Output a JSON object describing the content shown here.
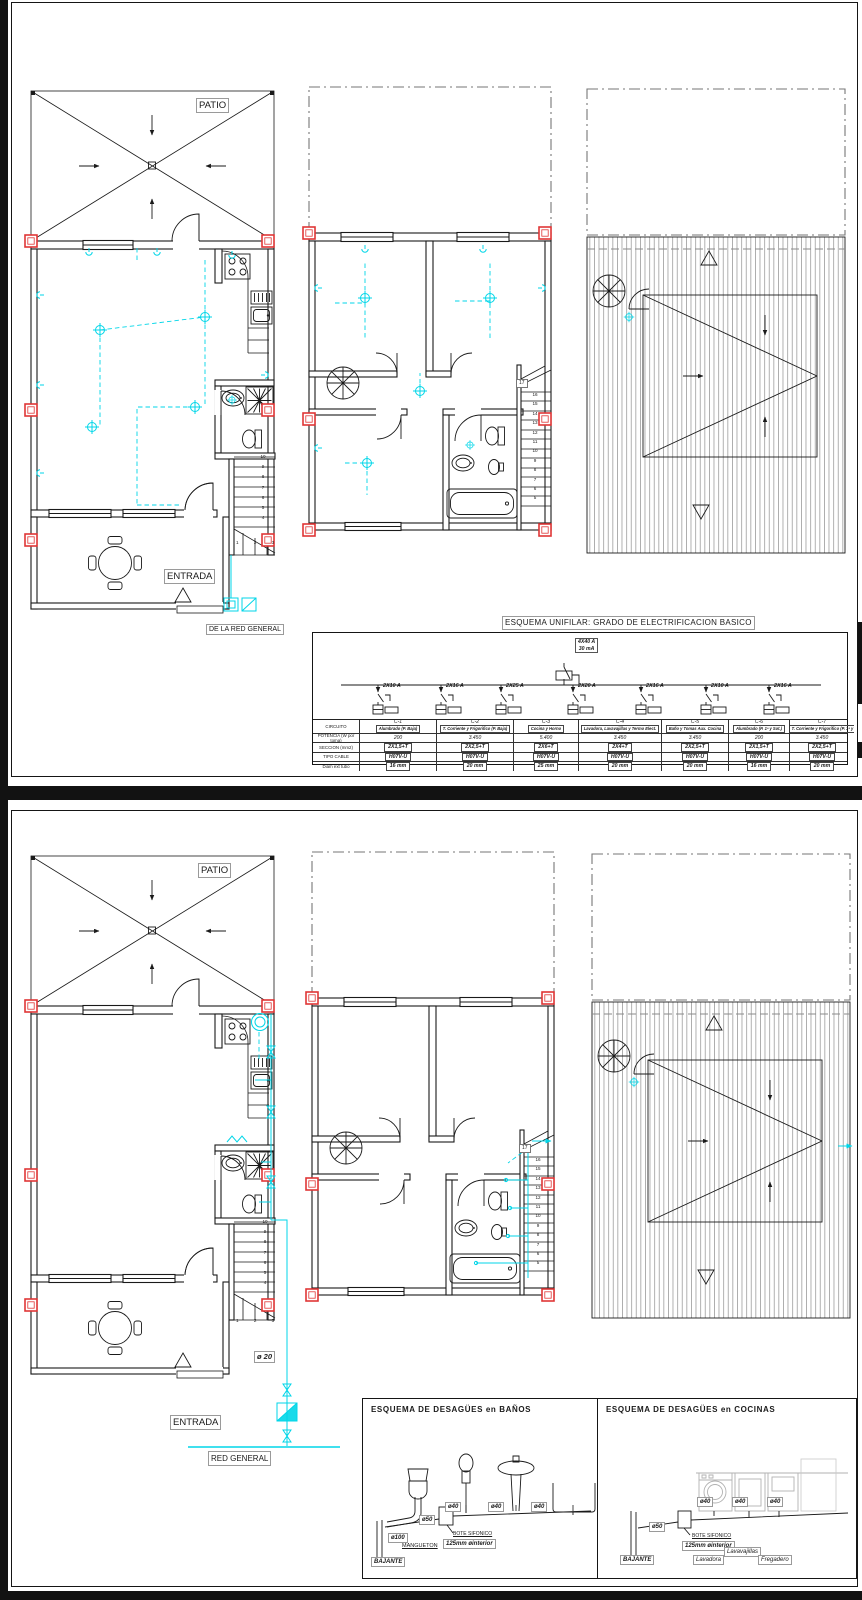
{
  "sheet1": {
    "ground": {
      "patio_label": "PATIO",
      "entrada_label": "ENTRADA",
      "service_label": "DE LA RED GENERAL",
      "stairs_col": "10\n9\n8\n7\n6\n5\n4",
      "stairs_bottom": "1 2 3"
    },
    "first": {
      "stairs_top": "17",
      "stairs_col": "16\n15\n14\n13\n12\n11\n10\n9\n8\n7\n6\n5"
    },
    "unifilar": {
      "title": "ESQUEMA UNIFILAR: GRADO DE ELECTRIFICACION BASICO",
      "main_breaker_a": "4X40 A",
      "main_breaker_ma": "30 mA",
      "breakers": [
        {
          "label": "2X10 A"
        },
        {
          "label": "2X16 A"
        },
        {
          "label": "2X25 A"
        },
        {
          "label": "2X20 A"
        },
        {
          "label": "2X16 A"
        },
        {
          "label": "2X10 A"
        },
        {
          "label": "2X16 A"
        }
      ],
      "row_labels": {
        "circuito": "CIRCUITO",
        "potencia": "POTENCIA (W por toma)",
        "seccion": "SECCION (mm2)",
        "cable": "TIPO CABLE",
        "diam": "Diam ext tubo"
      },
      "circuits": [
        {
          "id": "C-1",
          "name": "Alumbrado (P. Baja)",
          "pot": "200",
          "sec": "2X1,5+T",
          "cable": "H07V-U",
          "diam": "16 mm"
        },
        {
          "id": "C-2",
          "name": "T. Corriente y Frigorifico (P. Baja)",
          "pot": "3.450",
          "sec": "2X2,5+T",
          "cable": "H07V-U",
          "diam": "20 mm"
        },
        {
          "id": "C-3",
          "name": "Cocina y Horno",
          "pot": "5.400",
          "sec": "2X6+T",
          "cable": "H07V-U",
          "diam": "25 mm"
        },
        {
          "id": "C-4",
          "name": "Lavadora, Lavavajillas y Termo Elect.",
          "pot": "3.450",
          "sec": "2X4+T",
          "cable": "H07V-U",
          "diam": "20 mm"
        },
        {
          "id": "C-5",
          "name": "Baño y Tomas Aux. Cocina",
          "pot": "3.450",
          "sec": "2X2,5+T",
          "cable": "H07V-U",
          "diam": "20 mm"
        },
        {
          "id": "C-6",
          "name": "Alumbrado (P. 1ª y Sot.)",
          "pot": "200",
          "sec": "2X1,5+T",
          "cable": "H07V-U",
          "diam": "16 mm"
        },
        {
          "id": "C-7",
          "name": "T. Corriente y Frigorifico (P. 1ª y Sot.)",
          "pot": "3.450",
          "sec": "2X2,5+T",
          "cable": "H07V-U",
          "diam": "20 mm"
        }
      ]
    }
  },
  "sheet2": {
    "ground": {
      "patio_label": "PATIO",
      "entrada_label": "ENTRADA",
      "red_general_label": "RED GENERAL",
      "pipe_label": "ø 20",
      "stairs_col": "10\n9\n8\n7\n6\n5\n4",
      "stairs_bottom": "1 2 3"
    },
    "first": {
      "stairs_top": "17",
      "stairs_col": "16\n15\n14\n13\n12\n11\n10\n9\n8\n7\n6\n5"
    },
    "banos": {
      "title": "ESQUEMA DE DESAGÜES en BAÑOS",
      "bajante": "BAJANTE",
      "d100": "ø100",
      "mangueton": "MANGUETON",
      "d50": "ø50",
      "bote": "BOTE SIFONICO",
      "interior": "125mm  øinterior",
      "d40a": "ø40",
      "d40b": "ø40",
      "d40c": "ø40"
    },
    "cocinas": {
      "title": "ESQUEMA DE DESAGÜES en COCINAS",
      "bajante": "BAJANTE",
      "d50": "ø50",
      "bote": "BOTE SIFONICO",
      "interior": "125mm  øinterior",
      "d40a": "ø40",
      "d40b": "ø40",
      "d40c": "ø40",
      "lavadora": "Lavadora",
      "lavavajillas": "Lavavajillas",
      "fregadero": "Fregadero"
    }
  }
}
